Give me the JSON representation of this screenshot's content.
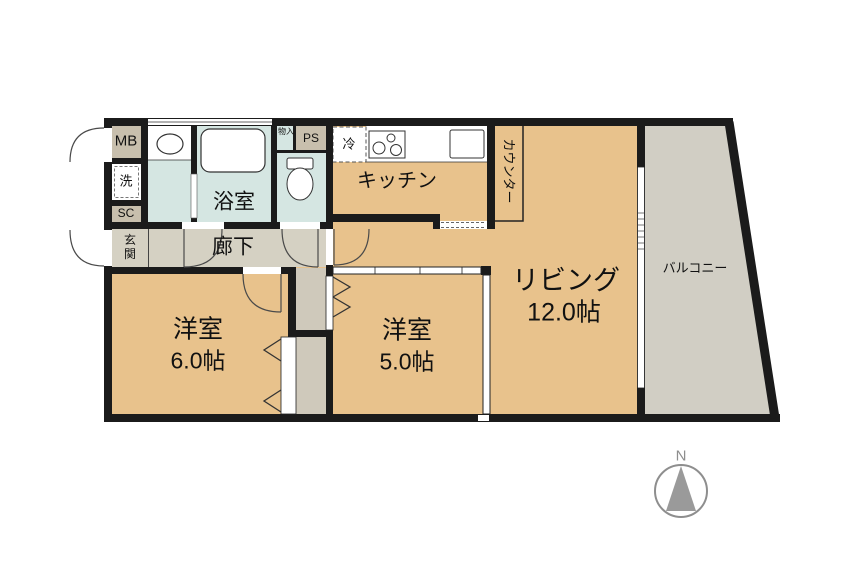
{
  "floorplan": {
    "rooms": {
      "living": {
        "label": "リビング",
        "size": "12.0帖"
      },
      "bedroom_6": {
        "label": "洋室",
        "size": "6.0帖"
      },
      "bedroom_5": {
        "label": "洋室",
        "size": "5.0帖"
      },
      "kitchen": {
        "label": "キッチン"
      },
      "bathroom": {
        "label": "浴室"
      },
      "hallway": {
        "label": "廊下"
      },
      "entrance": {
        "label": "玄関"
      },
      "balcony": {
        "label": "バルコニー"
      },
      "counter": {
        "label": "カウンター"
      },
      "meter_box": {
        "label": "MB"
      },
      "laundry": {
        "label": "洗"
      },
      "shoe_closet": {
        "label": "SC"
      },
      "pipe_space": {
        "label": "PS"
      },
      "storage": {
        "label": "物入"
      },
      "refrigerator": {
        "label": "冷"
      }
    },
    "compass": {
      "north_label": "N"
    },
    "colors": {
      "room_floor": "#e8c28c",
      "hallway_floor": "#d5d1c3",
      "wet_area_floor": "#d5e6e2",
      "balcony_floor": "#d1cec4",
      "utility_box": "#c8bfad",
      "closet": "#cfc9bb",
      "wall": "#1b1b1b",
      "compass_gray": "#8e8e8e"
    },
    "icons": [
      "bathtub-icon",
      "washbasin-sink-icon",
      "toilet-icon",
      "stove-icon",
      "kitchen-sink-icon",
      "door-swing-arc",
      "folding-door-chevron",
      "compass-icon"
    ]
  }
}
